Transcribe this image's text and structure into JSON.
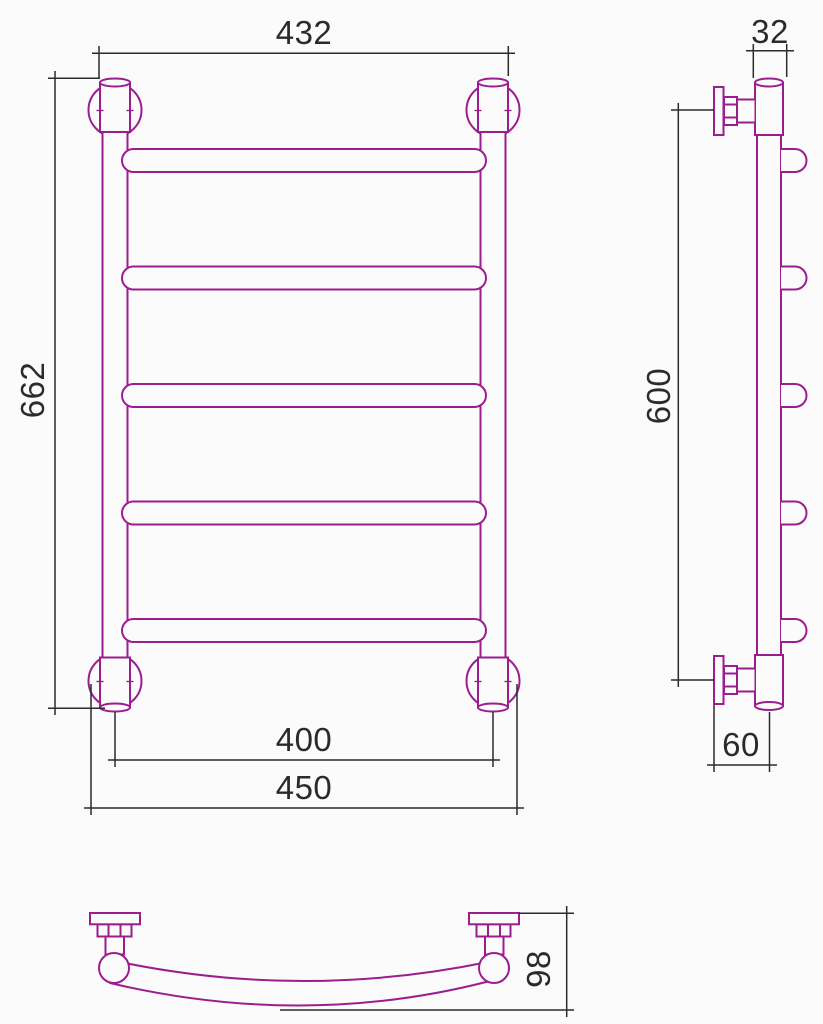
{
  "drawing": {
    "colors": {
      "outline": "#9b1e91",
      "dimension": "#2b2b2b",
      "background": "#fbfbfb"
    },
    "dimensions": {
      "front_top_width": "432",
      "front_height": "662",
      "front_axle_width": "400",
      "front_overall_width": "450",
      "side_tube_diameter": "32",
      "side_mount_height": "600",
      "side_wall_offset": "60",
      "plan_depth": "98"
    }
  }
}
